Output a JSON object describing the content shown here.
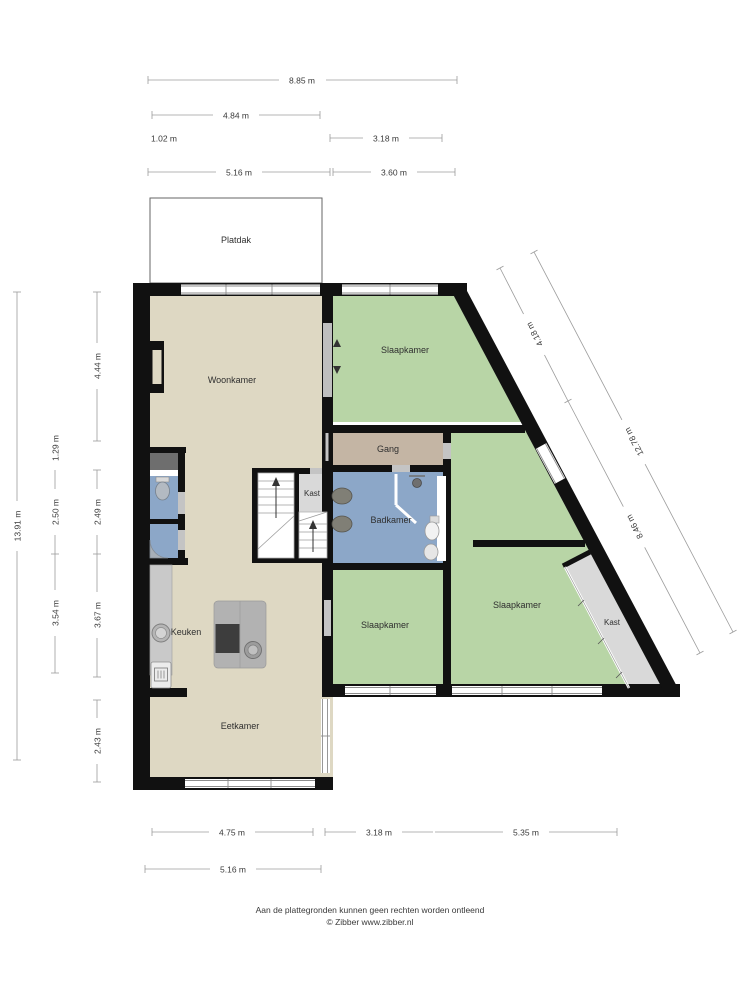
{
  "rooms": {
    "platdak": "Platdak",
    "woonkamer": "Woonkamer",
    "slaapkamer_top": "Slaapkamer",
    "slaapkamer_right": "Slaapkamer",
    "slaapkamer_middle": "Slaapkamer",
    "gang": "Gang",
    "badkamer": "Badkamer",
    "kast_center": "Kast",
    "kast_right": "Kast",
    "keuken": "Keuken",
    "eetkamer": "Eetkamer"
  },
  "dimensions": {
    "top": [
      {
        "label": "8.85 m"
      },
      {
        "label": "4.84 m"
      },
      {
        "label": "1.02 m"
      },
      {
        "label": "3.18 m"
      },
      {
        "label": "5.16 m"
      },
      {
        "label": "3.60 m"
      }
    ],
    "left": [
      {
        "label": "13.91 m"
      },
      {
        "label": "4.44 m"
      },
      {
        "label": "1.29 m"
      },
      {
        "label": "2.50 m"
      },
      {
        "label": "2.49 m"
      },
      {
        "label": "3.54 m"
      },
      {
        "label": "3.67 m"
      },
      {
        "label": "2.43 m"
      }
    ],
    "right": [
      {
        "label": "4.18 m"
      },
      {
        "label": "12.78 m"
      },
      {
        "label": "8.46 m"
      }
    ],
    "bottom": [
      {
        "label": "4.75 m"
      },
      {
        "label": "3.18 m"
      },
      {
        "label": "5.35 m"
      },
      {
        "label": "5.16 m"
      }
    ]
  },
  "footer": {
    "disclaimer": "Aan de plattegronden kunnen geen rechten worden ontleend",
    "credit": "© Zibber www.zibber.nl"
  },
  "colors": {
    "wall": "#111111",
    "living_floor": "#ded8c3",
    "bedroom_floor": "#b8d5a6",
    "bathroom_floor": "#8ca7c8",
    "hallway_floor": "#c4b5a4",
    "closet_floor": "#d9d9d9",
    "closet_dark": "#6e6e6e",
    "counter": "#c9c9c9",
    "island": "#b2b2b2",
    "appliance_dark": "#3d3d3d",
    "dimension_line": "#9b9b9b",
    "dimension_text": "#3a3a3a"
  }
}
